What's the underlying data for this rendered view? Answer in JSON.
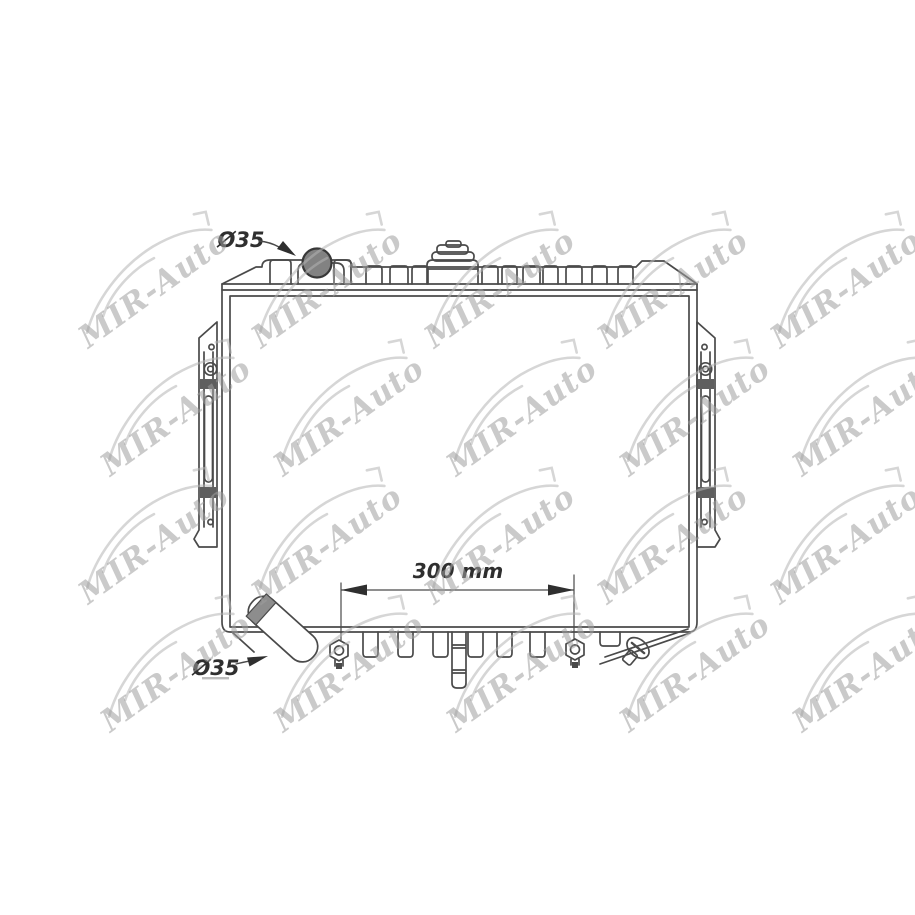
{
  "page": {
    "background": "#ffffff",
    "width_px": 915,
    "height_px": 915
  },
  "drawing": {
    "name": "radiator-line-drawing",
    "line_color": "#4a4a4a",
    "labels": {
      "inlet_diameter": "Ø35",
      "outlet_diameter": "Ø35",
      "mount_pin_spacing": "300 mm"
    }
  },
  "watermark": {
    "text": "MIR-Auto",
    "text_color": "#9f9f9f",
    "swoosh_color": "#b4b4b4",
    "opacity": 0.55,
    "rotation_deg": -36,
    "positions": [
      {
        "x": 160,
        "y": 297
      },
      {
        "x": 333,
        "y": 297
      },
      {
        "x": 506,
        "y": 297
      },
      {
        "x": 679,
        "y": 297
      },
      {
        "x": 852,
        "y": 297
      },
      {
        "x": 182,
        "y": 425
      },
      {
        "x": 355,
        "y": 425
      },
      {
        "x": 528,
        "y": 425
      },
      {
        "x": 701,
        "y": 425
      },
      {
        "x": 874,
        "y": 425
      },
      {
        "x": 160,
        "y": 553
      },
      {
        "x": 333,
        "y": 553
      },
      {
        "x": 506,
        "y": 553
      },
      {
        "x": 679,
        "y": 553
      },
      {
        "x": 852,
        "y": 553
      },
      {
        "x": 182,
        "y": 681
      },
      {
        "x": 355,
        "y": 681
      },
      {
        "x": 528,
        "y": 681
      },
      {
        "x": 701,
        "y": 681
      },
      {
        "x": 874,
        "y": 681
      }
    ]
  }
}
